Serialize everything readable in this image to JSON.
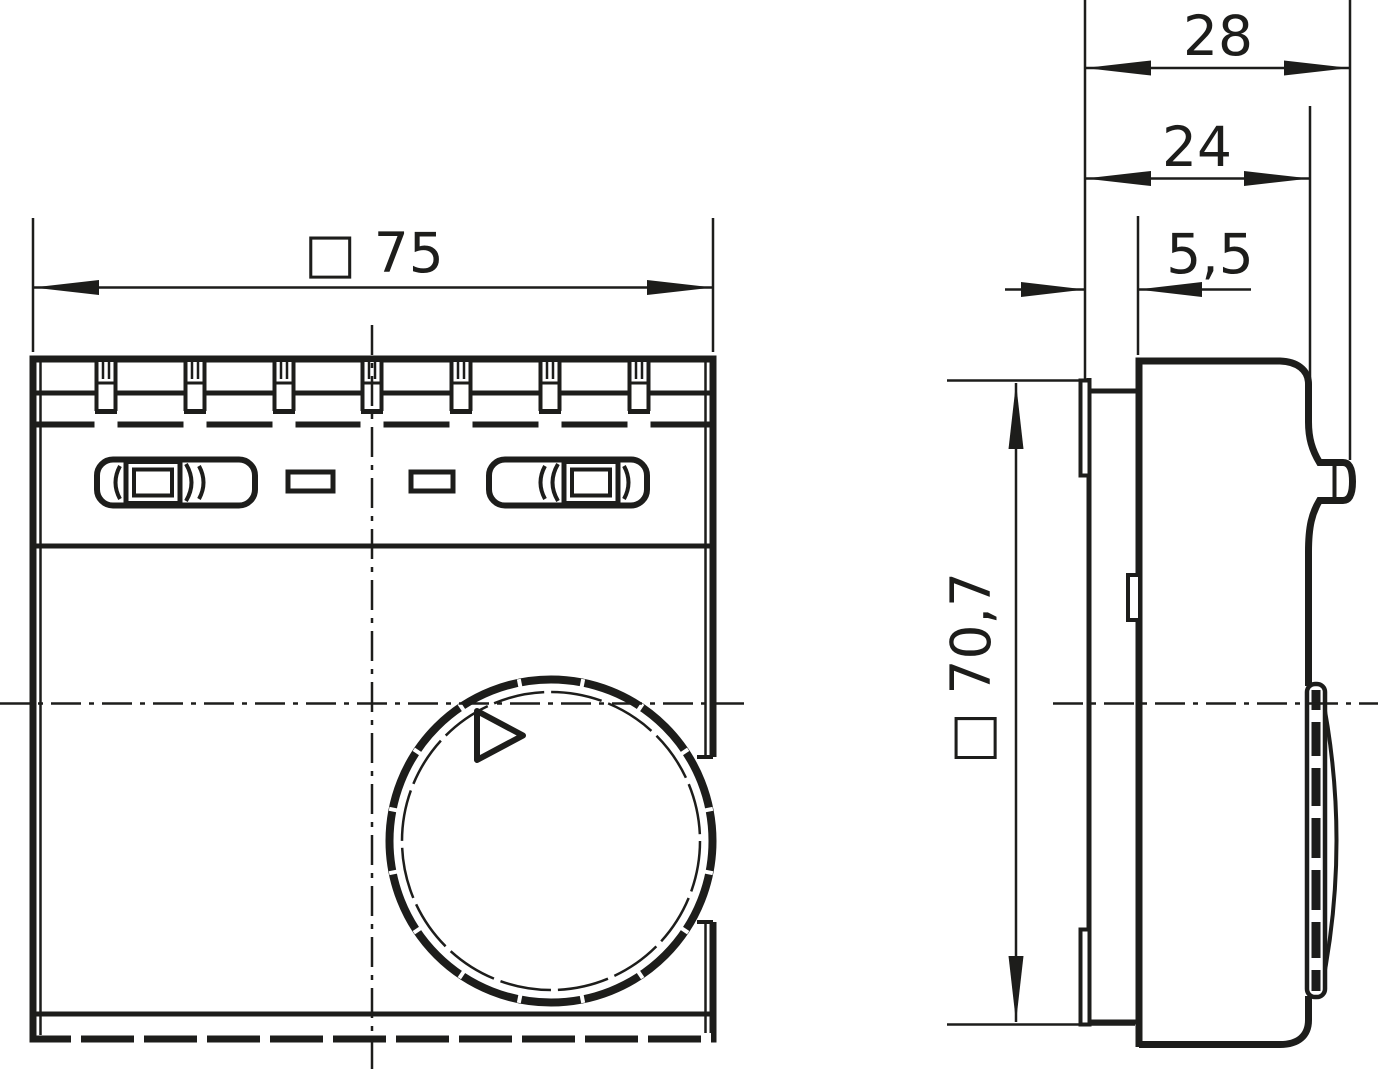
{
  "colors": {
    "ink": "#1d1d1b",
    "background": "#ffffff"
  },
  "dimensions": {
    "front_width": "□ 75",
    "side_total_depth": "28",
    "side_body_depth": "24",
    "side_plate_offset": "5,5",
    "side_height": "□ 70,7"
  }
}
